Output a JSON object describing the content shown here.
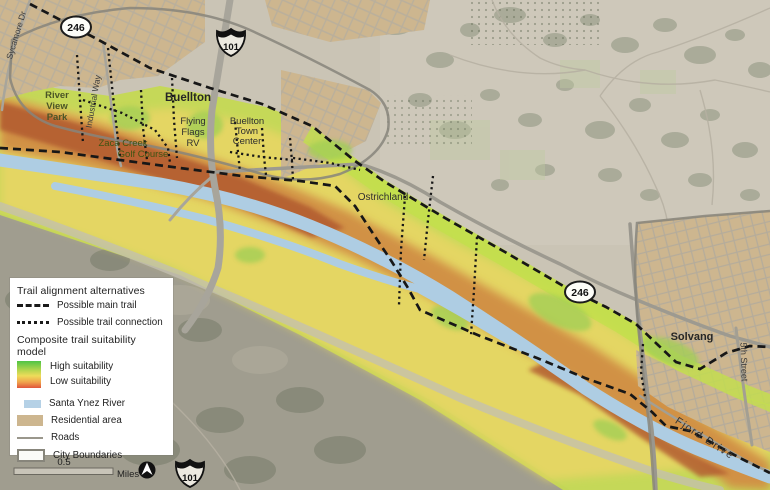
{
  "legend": {
    "trail_header": "Trail alignment alternatives",
    "main_trail": "Possible main trail",
    "trail_connection": "Possible trail connection",
    "suitability_header": "Composite trail suitability model",
    "high": "High suitability",
    "low": "Low suitability",
    "river": "Santa Ynez River",
    "residential": "Residential area",
    "roads": "Roads",
    "city": "City Boundaries"
  },
  "scale": {
    "value": "0.5",
    "unit": "Miles"
  },
  "shields": {
    "route_246": "246",
    "interstate_101": "101"
  },
  "places": {
    "buellton": "Buellton",
    "solvang": "Solvang",
    "ostrichland": "Ostrichland",
    "river_view_park": [
      "River",
      "View",
      "Park"
    ],
    "flying_flags": [
      "Flying",
      "Flags",
      "RV"
    ],
    "buellton_town_center": [
      "Buellton",
      "Town",
      "Center"
    ],
    "zaca_creek": [
      "Zaca Creek",
      "Golf Course"
    ]
  },
  "streets": {
    "sycamore": "Sycamore Dr",
    "industrial": "Industrial Way",
    "fifth": "5th Street",
    "fjord": "Fjord Drive"
  },
  "colors": {
    "high_suitability": "#4fc445",
    "mid_suitability": "#eedc5a",
    "low_suitability": "#e0553a",
    "band_green": "#c5da54",
    "band_yellow": "#e6d75f",
    "band_orange": "#d28f3f",
    "band_red": "#b2592a",
    "river": "#aecde3",
    "residential": "#cdb68f",
    "road": "#9a978c",
    "boundary": "#87857b",
    "trail": "#1a1a1a"
  }
}
